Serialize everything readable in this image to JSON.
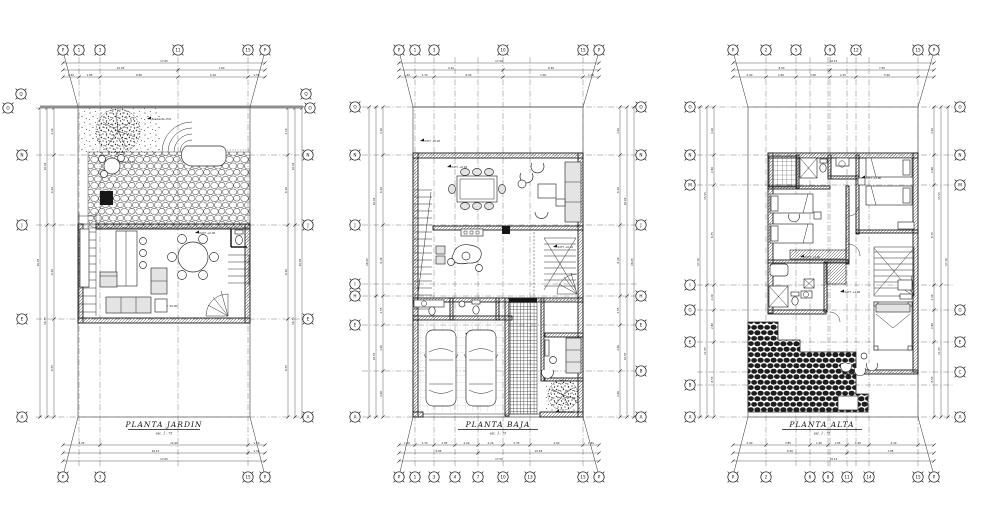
{
  "meta": {
    "sheet_background": "#ffffff",
    "ink": "#1a1a1a",
    "gray_accent": "#8f8f8f",
    "drawing_type": "Architectural floor plan sheet, 3 plans"
  },
  "plans": [
    {
      "id": "plan-garden",
      "title": "PLANTA JARDIN",
      "scale": "esc. 1 : 75",
      "grid": {
        "topBubbleY": 50,
        "bottomBubbleY": 477,
        "leftBX": 22,
        "rightBX": 308,
        "lineTop": 57,
        "lineBottom": 468,
        "lineLeft": 36,
        "lineRight": 303,
        "dimTop": [
          63,
          70,
          77
        ],
        "dimBottom": [
          461,
          453,
          445
        ],
        "dimLeft": [
          40,
          47,
          54
        ],
        "dimRight": [
          302,
          295,
          288
        ],
        "cols": [
          {
            "label": "P",
            "x": 63,
            "top": 1,
            "bottom": 1,
            "noline": 1
          },
          {
            "label": "1",
            "x": 79,
            "top": 1,
            "bottom": 0
          },
          {
            "label": "3",
            "x": 100,
            "top": 1,
            "bottom": 1
          },
          {
            "label": "11",
            "x": 178,
            "top": 1,
            "bottom": 0
          },
          {
            "label": "15",
            "x": 248,
            "top": 1,
            "bottom": 1
          },
          {
            "label": "P",
            "x": 265,
            "top": 1,
            "bottom": 1,
            "noline": 1
          }
        ],
        "rows": [
          {
            "label": "Q",
            "y": 94,
            "lx": 21,
            "rx": 306,
            "noline": 1,
            "dim": 0
          },
          {
            "label": "O",
            "y": 108,
            "lx": 8,
            "rx": 310
          },
          {
            "label": "N",
            "y": 155
          },
          {
            "label": "J",
            "y": 225
          },
          {
            "label": "E",
            "y": 319
          },
          {
            "label": "A",
            "y": 417
          }
        ]
      },
      "dims": {
        "top_total": "17.65",
        "top_sub": [
          "10.05",
          "7.60"
        ],
        "top_segs": [
          "1.40",
          "1.85",
          "6.80",
          "6.10",
          "1.50"
        ],
        "bottom_total": "17.65",
        "bottom_sub": [
          "16.15",
          "1.50"
        ],
        "bottom_segs": [
          "3.25",
          "12.90",
          "1.50"
        ],
        "side_total": "26.95",
        "side_sub": [
          "10.20",
          "16.75"
        ],
        "side_segs": [
          "4.10",
          "6.10",
          "8.20",
          "8.55"
        ]
      },
      "notes": [
        {
          "x": 152,
          "y": 119,
          "t": "pendiente 15%"
        },
        {
          "x": 120,
          "y": 162,
          "t": "N.P.T. +0.15"
        },
        {
          "x": 200,
          "y": 233,
          "t": "N.P.T. +0.30"
        },
        {
          "x": 162,
          "y": 306,
          "t": "N.P.T. ±0.00"
        }
      ]
    },
    {
      "id": "plan-baja",
      "title": "PLANTA BAJA",
      "scale": "esc. 1 : 75",
      "grid": {
        "topBubbleY": 50,
        "bottomBubbleY": 477,
        "leftBX": 355,
        "rightBX": 641,
        "lineTop": 57,
        "lineBottom": 468,
        "lineLeft": 362,
        "lineRight": 638,
        "dimTop": [
          63,
          70,
          77
        ],
        "dimBottom": [
          461,
          453,
          445
        ],
        "dimLeft": [
          369,
          376,
          383
        ],
        "dimRight": [
          634,
          627,
          620
        ],
        "cols": [
          {
            "label": "P",
            "x": 399,
            "top": 1,
            "bottom": 1,
            "noline": 1
          },
          {
            "label": "1",
            "x": 415,
            "top": 1,
            "bottom": 1
          },
          {
            "label": "3",
            "x": 434,
            "top": 1,
            "bottom": 1
          },
          {
            "label": "4",
            "x": 455,
            "top": 0,
            "bottom": 1
          },
          {
            "label": "7",
            "x": 478,
            "top": 0,
            "bottom": 1
          },
          {
            "label": "10",
            "x": 503,
            "top": 1,
            "bottom": 1
          },
          {
            "label": "13",
            "x": 530,
            "top": 0,
            "bottom": 1
          },
          {
            "label": "15",
            "x": 583,
            "top": 1,
            "bottom": 1
          },
          {
            "label": "P",
            "x": 599,
            "top": 1,
            "bottom": 1,
            "noline": 1
          }
        ],
        "rows": [
          {
            "label": "O",
            "y": 107
          },
          {
            "label": "N",
            "y": 155
          },
          {
            "label": "J",
            "y": 225
          },
          {
            "label": "I",
            "y": 284,
            "right": 0,
            "dim": 0
          },
          {
            "label": "H",
            "y": 296
          },
          {
            "label": "E",
            "y": 325
          },
          {
            "label": "B",
            "y": 371,
            "left": 0
          },
          {
            "label": "A",
            "y": 417
          }
        ]
      },
      "dims": {
        "top_total": "17.50",
        "top_sub": [
          "9.10",
          "8.40"
        ],
        "top_segs": [
          "1.40",
          "1.70",
          "6.00",
          "7.00",
          "1.40"
        ],
        "bottom_total": "17.50",
        "bottom_sub": [
          "6.85",
          "10.65"
        ],
        "bottom_segs": [
          "1.40",
          "1.70",
          "1.85",
          "2.00",
          "2.20",
          "2.35",
          "4.60",
          "1.40"
        ],
        "side_total": "26.95",
        "side_sub": [
          "16.40",
          "10.55"
        ],
        "side_segs": [
          "4.20",
          "6.10",
          "6.20",
          "2.55",
          "4.00",
          "4.00"
        ]
      },
      "notes": [
        {
          "x": 425,
          "y": 141,
          "t": "N.P.T. +0.45"
        },
        {
          "x": 452,
          "y": 167,
          "t": "N.P.T. +0.45"
        },
        {
          "x": 558,
          "y": 247,
          "t": "N.P.T. +0.45"
        },
        {
          "x": 470,
          "y": 334,
          "t": "N.P.T. ±0.00"
        },
        {
          "x": 560,
          "y": 412,
          "t": "N.P.T. -0.15"
        }
      ]
    },
    {
      "id": "plan-alta",
      "title": "PLANTA ALTA",
      "scale": "esc. 1 : 75",
      "grid": {
        "topBubbleY": 50,
        "bottomBubbleY": 477,
        "leftBX": 690,
        "rightBX": 960,
        "lineTop": 57,
        "lineBottom": 468,
        "lineLeft": 697,
        "lineRight": 954,
        "dimTop": [
          63,
          70,
          77
        ],
        "dimBottom": [
          461,
          453,
          445
        ],
        "dimLeft": [
          700,
          707,
          714
        ],
        "dimRight": [
          948,
          941,
          934
        ],
        "cols": [
          {
            "label": "P",
            "x": 733,
            "top": 1,
            "bottom": 1,
            "noline": 1
          },
          {
            "label": "2",
            "x": 766,
            "top": 1,
            "bottom": 1
          },
          {
            "label": "5",
            "x": 796,
            "top": 1,
            "bottom": 0
          },
          {
            "label": "6",
            "x": 810,
            "top": 0,
            "bottom": 1
          },
          {
            "label": "8",
            "x": 828,
            "top": 0,
            "bottom": 1
          },
          {
            "label": "9",
            "x": 830,
            "top": 1,
            "bottom": 0
          },
          {
            "label": "11",
            "x": 847,
            "top": 0,
            "bottom": 1
          },
          {
            "label": "12",
            "x": 856,
            "top": 1,
            "bottom": 0
          },
          {
            "label": "14",
            "x": 869,
            "top": 0,
            "bottom": 1
          },
          {
            "label": "15",
            "x": 918,
            "top": 1,
            "bottom": 1
          },
          {
            "label": "P",
            "x": 934,
            "top": 1,
            "bottom": 1,
            "noline": 1
          }
        ],
        "rows": [
          {
            "label": "O",
            "y": 107
          },
          {
            "label": "N",
            "y": 155
          },
          {
            "label": "M",
            "y": 185
          },
          {
            "label": "I",
            "y": 285,
            "right": 0
          },
          {
            "label": "G",
            "y": 310
          },
          {
            "label": "E",
            "y": 342
          },
          {
            "label": "C",
            "y": 372,
            "left": 0,
            "dim": 0
          },
          {
            "label": "B",
            "y": 385,
            "right": 0,
            "dim": 0
          },
          {
            "label": "A",
            "y": 417
          }
        ]
      },
      "dims": {
        "top_total": "16.15",
        "top_sub": [
          "8.50",
          "7.65"
        ],
        "top_segs": [
          "2.90",
          "2.60",
          "3.00",
          "2.25",
          "5.40"
        ],
        "bottom_total": "16.15",
        "bottom_sub": [
          "8.30",
          "7.85"
        ],
        "bottom_segs": [
          "2.90",
          "3.85",
          "1.60",
          "1.65",
          "1.90",
          "4.30"
        ],
        "side_total": "27.10",
        "side_sub": [
          "15.55",
          "11.55"
        ],
        "side_segs": [
          "4.20",
          "2.60",
          "8.75",
          "2.20",
          "2.80",
          "6.55"
        ]
      },
      "notes": [
        {
          "x": 866,
          "y": 178,
          "t": "N.P.T. +2.80"
        },
        {
          "x": 805,
          "y": 257,
          "t": "N.P.T. +2.80"
        },
        {
          "x": 845,
          "y": 292,
          "t": "N.P.T. +2.80"
        },
        {
          "x": 790,
          "y": 408,
          "t": "N.AZ. +2.65"
        }
      ]
    }
  ]
}
